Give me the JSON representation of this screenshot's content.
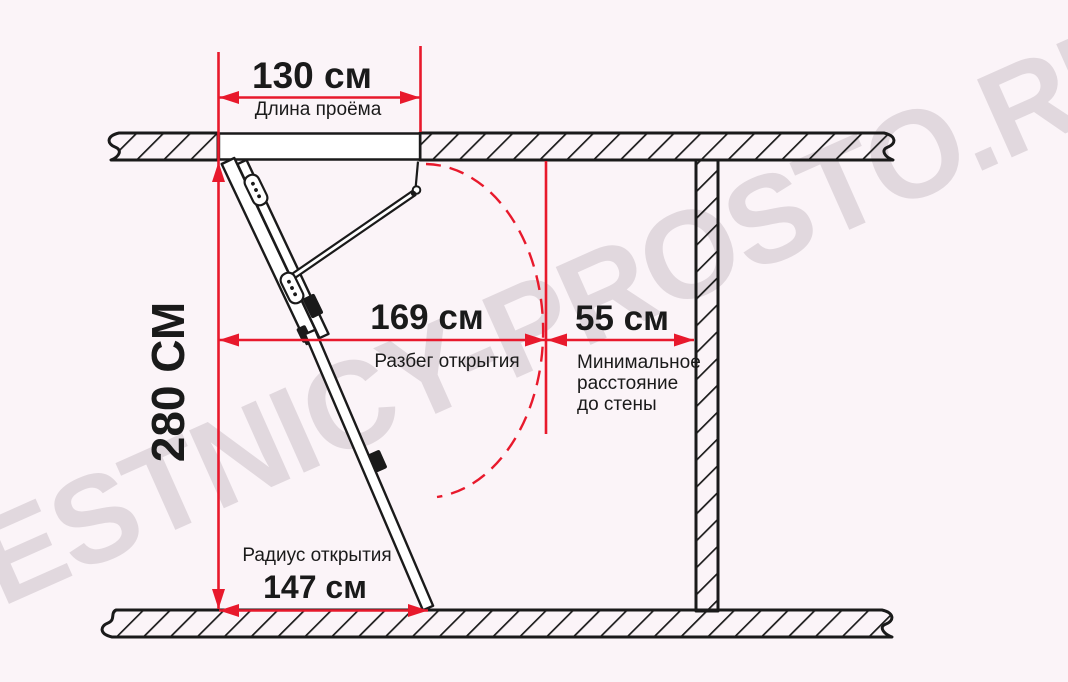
{
  "watermark": {
    "text": "LESTNICY-PROSTO.RU"
  },
  "dims": {
    "opening_length": {
      "value": "130 см",
      "label": "Длина проёма"
    },
    "height": {
      "value": "280 СМ"
    },
    "run": {
      "value": "169 см",
      "label": "Разбег открытия"
    },
    "wall": {
      "value": "55 см",
      "label": "Минимальное\nрасстояние\nдо стены"
    },
    "radius": {
      "value": "147 см",
      "label": "Радиус открытия"
    }
  },
  "colors": {
    "dimension_red": "#e8192c",
    "line_black": "#1a1a1a",
    "background_pink": "#f8edf3",
    "watermark_gray": "#a799a2"
  }
}
